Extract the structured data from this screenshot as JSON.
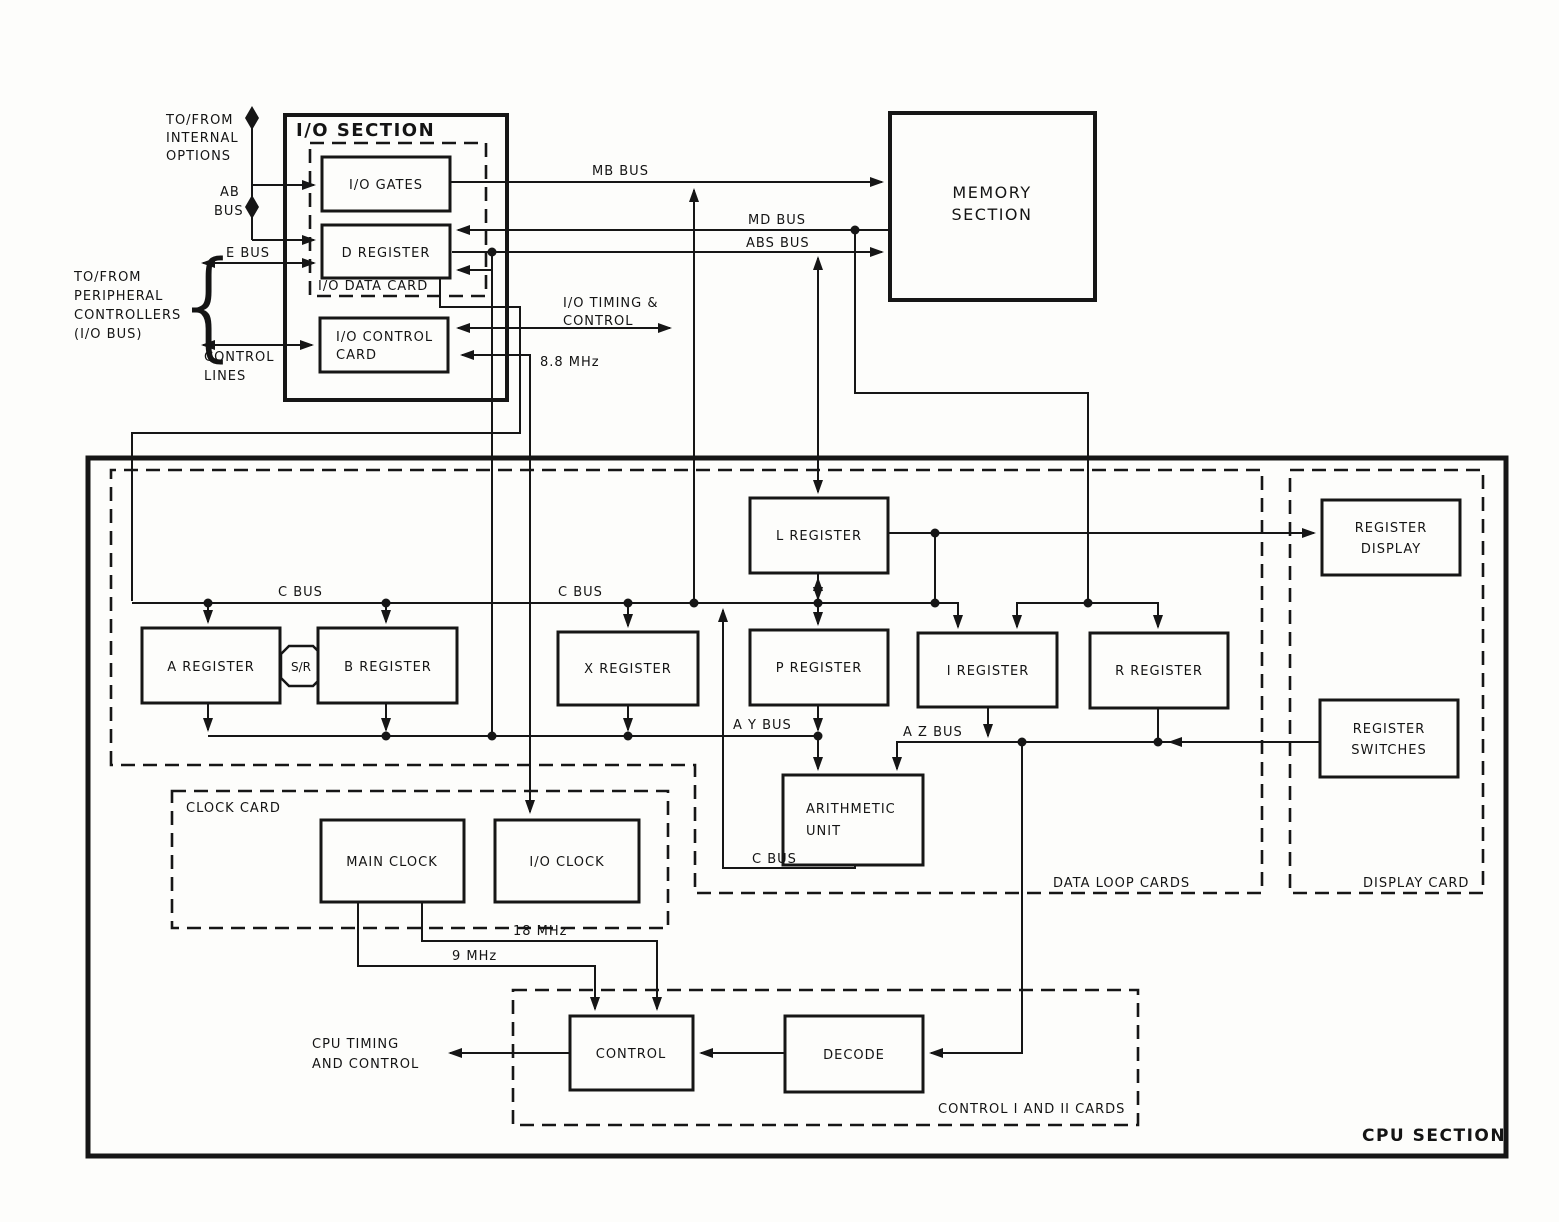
{
  "sections": {
    "io_title": "I/O SECTION",
    "memory_l1": "MEMORY",
    "memory_l2": "SECTION",
    "cpu_title": "CPU SECTION"
  },
  "cards": {
    "io_data": "I/O DATA CARD",
    "clock": "CLOCK CARD",
    "data_loop": "DATA LOOP CARDS",
    "display": "DISPLAY CARD",
    "control": "CONTROL I AND II CARDS"
  },
  "blocks": {
    "io_gates": "I/O GATES",
    "d_register": "D REGISTER",
    "io_control_l1": "I/O CONTROL",
    "io_control_l2": "CARD",
    "a_register": "A REGISTER",
    "sr": "S/R",
    "b_register": "B REGISTER",
    "x_register": "X REGISTER",
    "p_register": "P REGISTER",
    "i_register": "I REGISTER",
    "r_register": "R REGISTER",
    "l_register": "L REGISTER",
    "au_l1": "ARITHMETIC",
    "au_l2": "UNIT",
    "register_display_l1": "REGISTER",
    "register_display_l2": "DISPLAY",
    "register_switches_l1": "REGISTER",
    "register_switches_l2": "SWITCHES",
    "main_clock": "MAIN CLOCK",
    "io_clock": "I/O CLOCK",
    "control": "CONTROL",
    "decode": "DECODE"
  },
  "buses": {
    "mb": "MB BUS",
    "md": "MD BUS",
    "abs": "ABS BUS",
    "e": "E BUS",
    "c1": "C BUS",
    "c2": "C BUS",
    "c3": "C BUS",
    "ay": "A Y BUS",
    "az": "A Z BUS"
  },
  "freq": {
    "f88": "8.8 MHz",
    "f18": "18 MHz",
    "f9": "9 MHz"
  },
  "ann": {
    "internal_l1": "TO/FROM",
    "internal_l2": "INTERNAL",
    "internal_l3": "OPTIONS",
    "periph_l1": "TO/FROM",
    "periph_l2": "PERIPHERAL",
    "periph_l3": "CONTROLLERS",
    "periph_l4": "(I/O BUS)",
    "brace": "{",
    "ab_l1": "AB",
    "ab_l2": "BUS",
    "ctl_lines_l1": "CONTROL",
    "ctl_lines_l2": "LINES",
    "io_timing_l1": "I/O TIMING &",
    "io_timing_l2": "CONTROL",
    "cpu_timing_l1": "CPU TIMING",
    "cpu_timing_l2": "AND CONTROL"
  },
  "colors": {
    "ink": "#161616",
    "paper": "#fdfdfb"
  }
}
